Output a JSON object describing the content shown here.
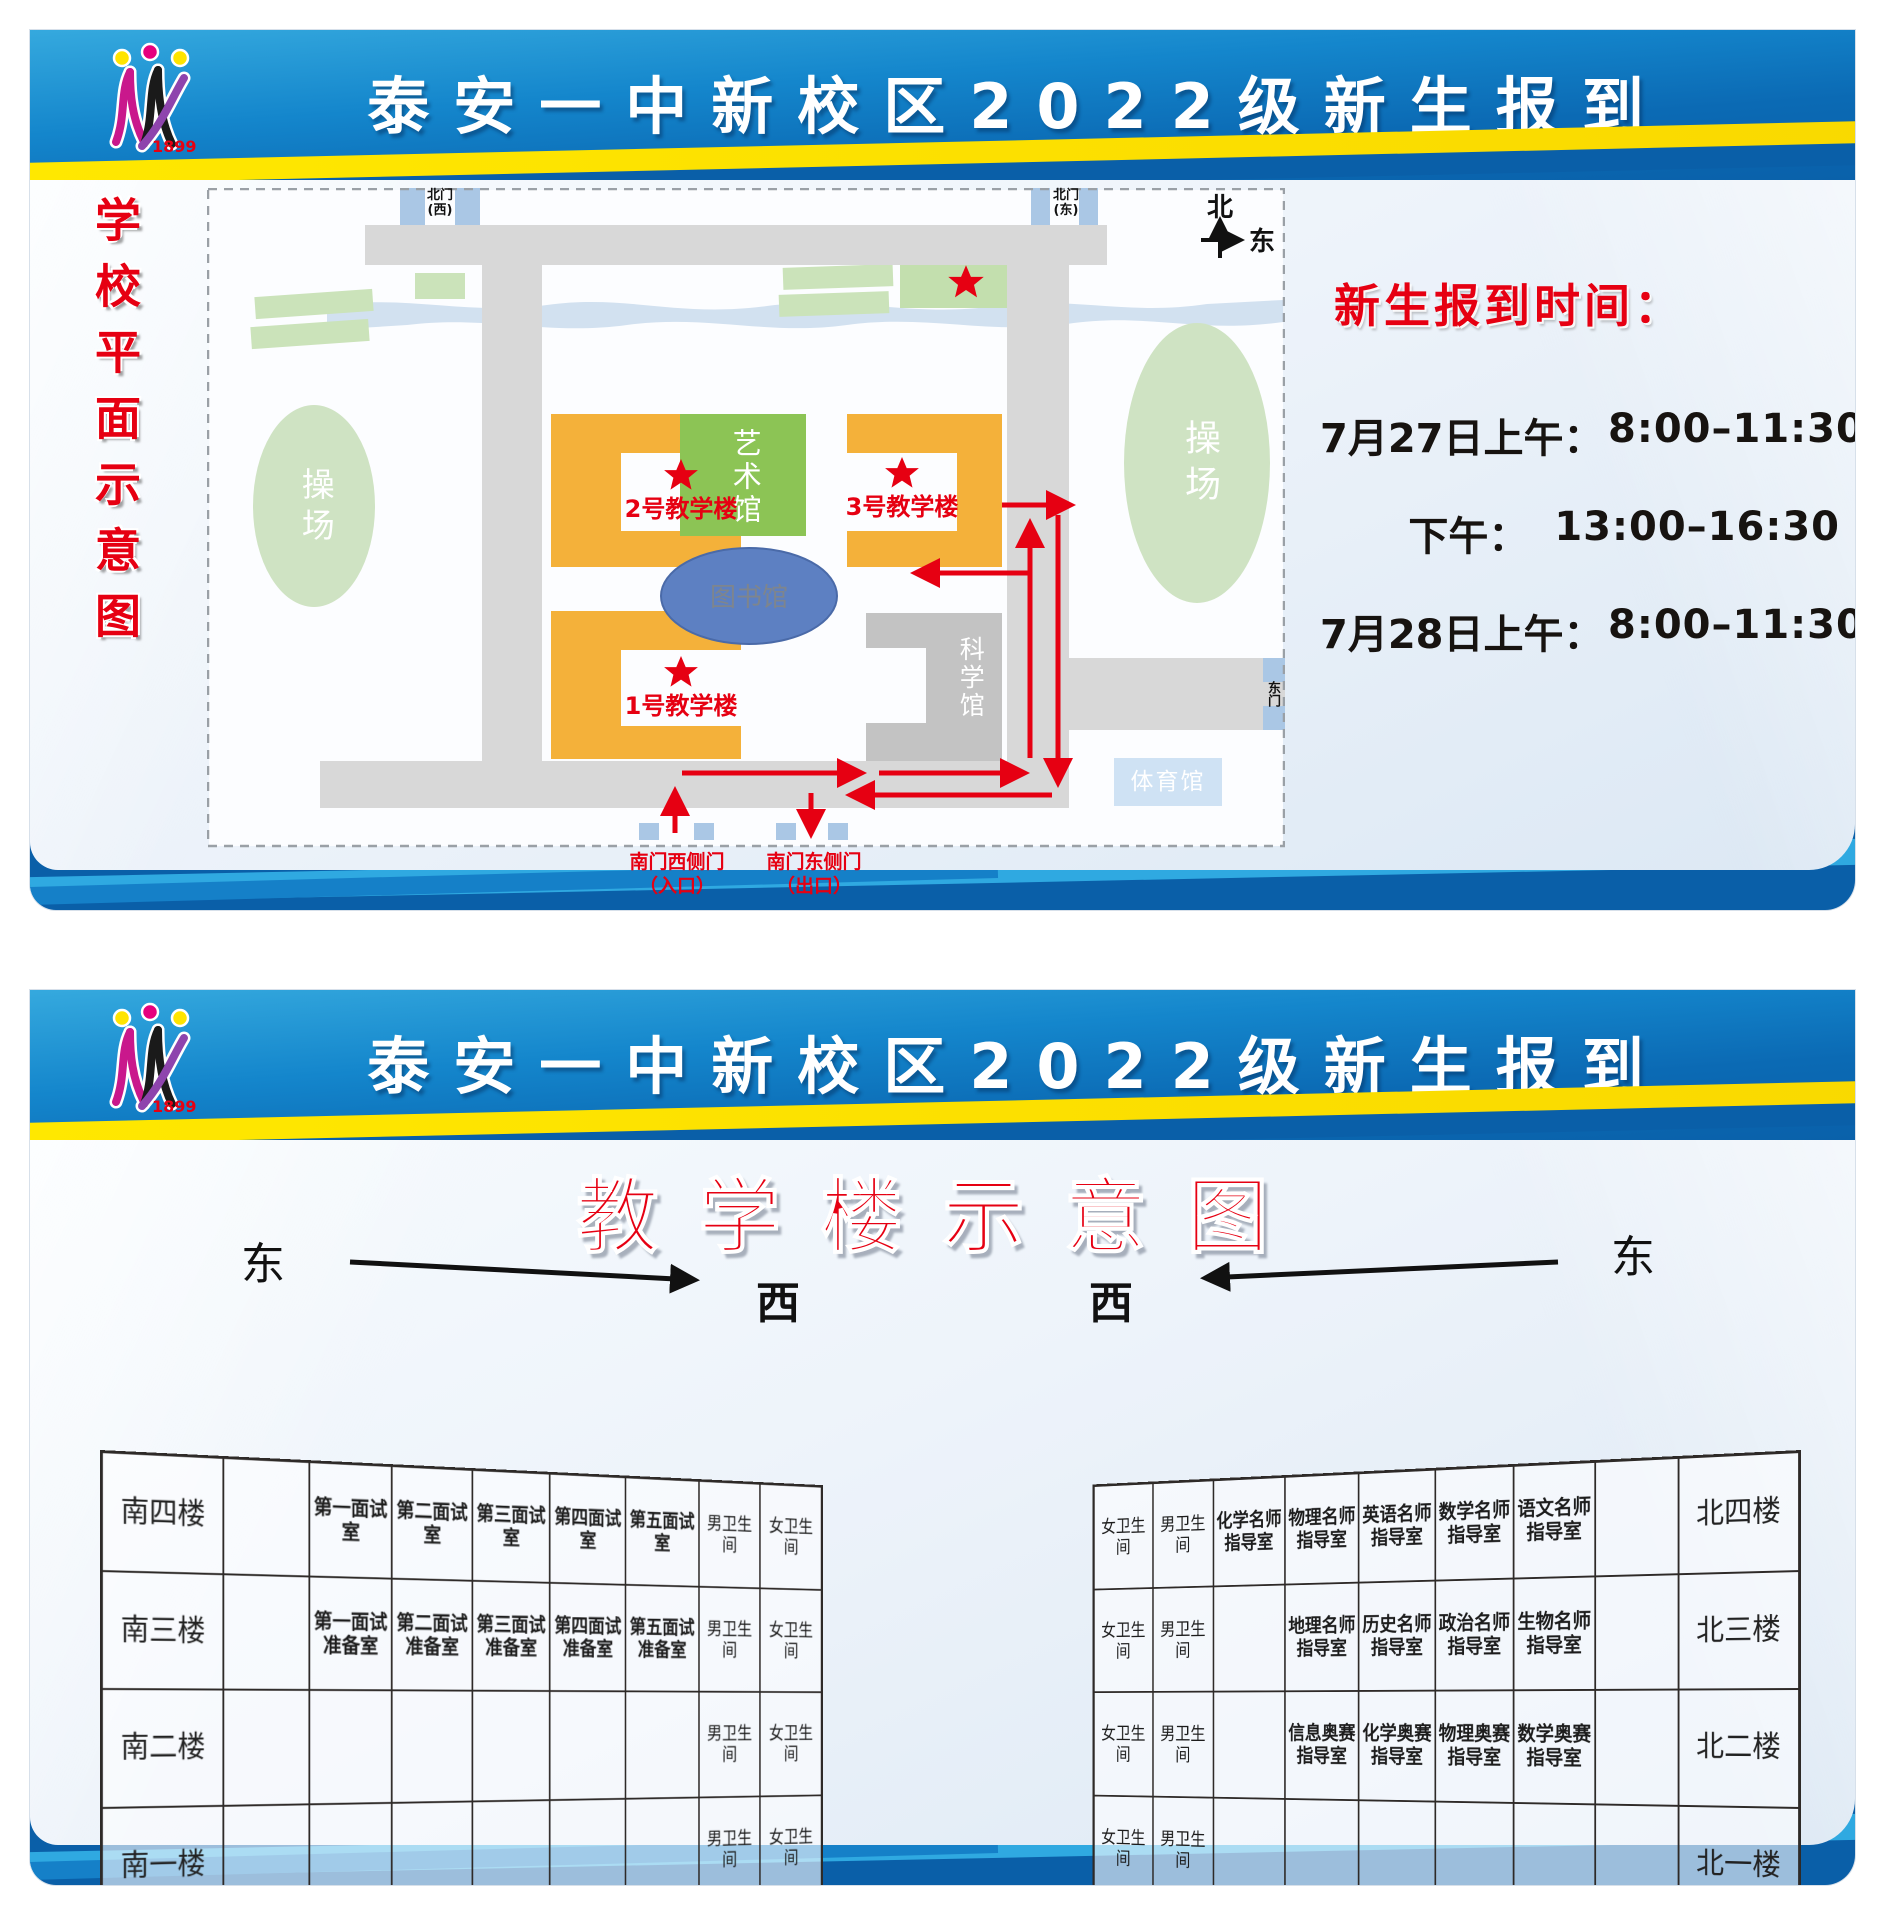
{
  "shared": {
    "header_title": "泰安一中新校区2022级新生报到",
    "logo_year": "1899"
  },
  "panel1": {
    "side_title": "学校平面示意图",
    "schedule": {
      "heading": "新生报到时间：",
      "rows": [
        {
          "label": "7月27日上午：",
          "time": "8:00–11:30"
        },
        {
          "label": "下午：",
          "time": "13:00–16:30"
        },
        {
          "label": "7月28日上午：",
          "time": "8:00–11:30"
        }
      ]
    },
    "map": {
      "compass": {
        "north": "北",
        "east": "东"
      },
      "gates": {
        "north_west": [
          "北门",
          "(西)"
        ],
        "north_east": [
          "北门",
          "(东)"
        ],
        "east": "东门",
        "south_west": [
          "南门西侧门",
          "（入口）"
        ],
        "south_east": [
          "南门东侧门",
          "（出口）"
        ]
      },
      "labels": {
        "playground": "操场",
        "art": "艺术馆",
        "library": "图书馆",
        "science": "科学馆",
        "gym": "体育馆",
        "b1": "1号教学楼",
        "b2": "2号教学楼",
        "b3": "3号教学楼"
      }
    }
  },
  "panel2": {
    "title": "教学楼示意图",
    "directions": {
      "east": "东",
      "west": "西",
      "north": "北"
    },
    "south_table": {
      "col_widths": [
        15,
        11,
        11,
        11,
        11,
        11,
        11,
        9.5,
        9.5
      ],
      "bold_cols": [
        2,
        3,
        4,
        5,
        6
      ],
      "label_col": 0,
      "rows": [
        [
          "南四楼",
          "",
          "第一面试室",
          "第二面试室",
          "第三面试室",
          "第四面试室",
          "第五面试室",
          "男卫生间",
          "女卫生间"
        ],
        [
          "南三楼",
          "",
          "第一面试准备室",
          "第二面试准备室",
          "第三面试准备室",
          "第四面试准备室",
          "第五面试准备室",
          "男卫生间",
          "女卫生间"
        ],
        [
          "南二楼",
          "",
          "",
          "",
          "",
          "",
          "",
          "男卫生间",
          "女卫生间"
        ],
        [
          "南一楼",
          "",
          "",
          "",
          "",
          "",
          "",
          "男卫生间",
          "女卫生间"
        ]
      ],
      "footer": [
        {
          "text": "楼梯",
          "span": 4
        },
        {
          "text": "",
          "span": 5
        }
      ]
    },
    "north_table": {
      "col_widths": [
        9.5,
        9.5,
        11,
        11,
        11,
        11,
        11,
        11,
        15
      ],
      "bold_cols": [
        2,
        3,
        4,
        5,
        6
      ],
      "label_col": 8,
      "rows": [
        [
          "女卫生间",
          "男卫生间",
          "化学名师指导室",
          "物理名师指导室",
          "英语名师指导室",
          "数学名师指导室",
          "语文名师指导室",
          "",
          "北四楼"
        ],
        [
          "女卫生间",
          "男卫生间",
          "",
          "地理名师指导室",
          "历史名师指导室",
          "政治名师指导室",
          "生物名师指导室",
          "",
          "北三楼"
        ],
        [
          "女卫生间",
          "男卫生间",
          "",
          "信息奥赛指导室",
          "化学奥赛指导室",
          "物理奥赛指导室",
          "数学奥赛指导室",
          "",
          "北二楼"
        ],
        [
          "女卫生间",
          "男卫生间",
          "",
          "",
          "",
          "",
          "",
          "",
          "北一楼"
        ]
      ],
      "footer": [
        {
          "text": "",
          "span": 5
        },
        {
          "text": "楼梯",
          "span": 4
        }
      ]
    }
  }
}
